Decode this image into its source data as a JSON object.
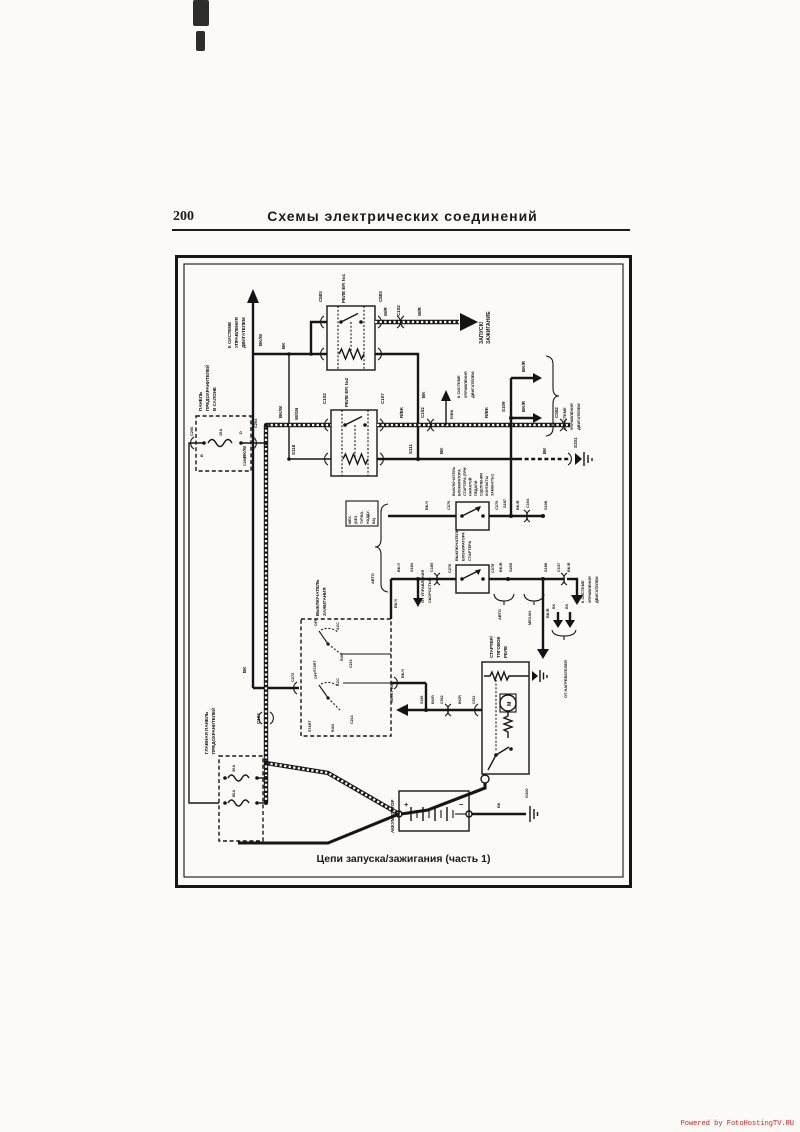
{
  "page": {
    "number": "200",
    "title": "Схемы  электрических  соединений",
    "caption": "Цепи запуска/зажигания (часть 1)",
    "watermark": "Powered by FotoHostingTV.RU"
  },
  "colors": {
    "ink": "#1a1a1a",
    "paper": "#fbfaf7",
    "watermark": "#cc2222"
  },
  "diagram": {
    "arrows": {
      "sys_ctrl": [
        "К СИСТЕМЕ",
        "УПРАВЛЕНИЯ",
        "ДВИГАТЕЛЕМ"
      ],
      "start_ign": [
        "ЗАПУСК/",
        "ЗАЖИГАНИЕ"
      ],
      "speed_ctrl": [
        "ОТ УПРАВЛЕНИЯ",
        "СКОРОСТЬЮ"
      ],
      "heating": "ОБОГРЕВ",
      "heaters": "ОТ НАГРЕВАТЕЛЕЙ"
    },
    "components": {
      "relay1": "РЕЛЕ EFI №1",
      "relay2": "РЕЛЕ EFI №2",
      "cabin_fuse_panel": [
        "ПАНЕЛЬ",
        "ПРЕДОХРАНИТЕЛЕЙ",
        "В САЛОНЕ"
      ],
      "main_fuse_panel": [
        "ГЛАВНАЯ ПАНЕЛЬ",
        "ПРЕДОХРАНИТЕЛЕЙ"
      ],
      "interlock1": [
        "ВЫКЛЮЧАТЕЛЬ",
        "БЛОКИРАТОРА",
        "СТАРТЕРА (ПРИ",
        "НАЖАТОЙ",
        "ПЕДАЛИ",
        "СЦЕПЛЕНИЯ",
        "КОНТАКТЫ",
        "ЗАМКНУТЫ)"
      ],
      "interlock2": [
        "ВЫКЛЮЧАТЕЛЬ",
        "БЛОКИРАТОРА",
        "СТАРТЕРА"
      ],
      "ignition_switch": [
        "ВЫКЛЮЧАТЕЛЬ",
        "ЗАЖИГАНИЯ"
      ],
      "battery": "АККУМУЛЯТОР",
      "starter_relay": [
        "СТАРТЕР/",
        "ТЯГОВОЕ",
        "РЕЛЕ"
      ],
      "mech_no_turbo": [
        "МЕХ.",
        "(БЕЗ",
        "ТУРБО-",
        "НАДДУ-",
        "ВА)"
      ],
      "auto": "АВТО",
      "mechan": "МЕХАН.",
      "motor": "M"
    },
    "switch_positions": {
      "off": "OFF",
      "acc": "ACC",
      "run": "RUN",
      "start": "START"
    },
    "fuses": {
      "cabin": "15A",
      "main1": "30A",
      "main2": "80A"
    },
    "pins": {
      "b": "B",
      "d": "D",
      "plus": "+",
      "minus": "−"
    },
    "wires": {
      "bkw": "BK/W",
      "bk": "BK",
      "wr": "W/R",
      "wgn": "W/GN",
      "rbk": "R/BK",
      "bky": "BK/Y",
      "bkr": "BK/R"
    },
    "connectors": {
      "c883": "C883",
      "c102": "C102",
      "c107": "C107",
      "c204": "C204",
      "c206": "C206",
      "s118": "S118",
      "s111": "S111",
      "s101": "S101",
      "c279": "C279",
      "s187": "S187",
      "c104": "C104",
      "s108": "S108",
      "s109": "S109",
      "c276": "C276",
      "c278": "C278",
      "s205": "S205",
      "s188": "S188",
      "c137": "C137",
      "s184": "S184",
      "c185": "C185",
      "s189": "S189",
      "c562": "C562",
      "c511": "C511",
      "c272": "C272",
      "c216": "C216",
      "c214": "C214",
      "c103": "C103",
      "g100": "G100",
      "c552": "C552"
    }
  }
}
